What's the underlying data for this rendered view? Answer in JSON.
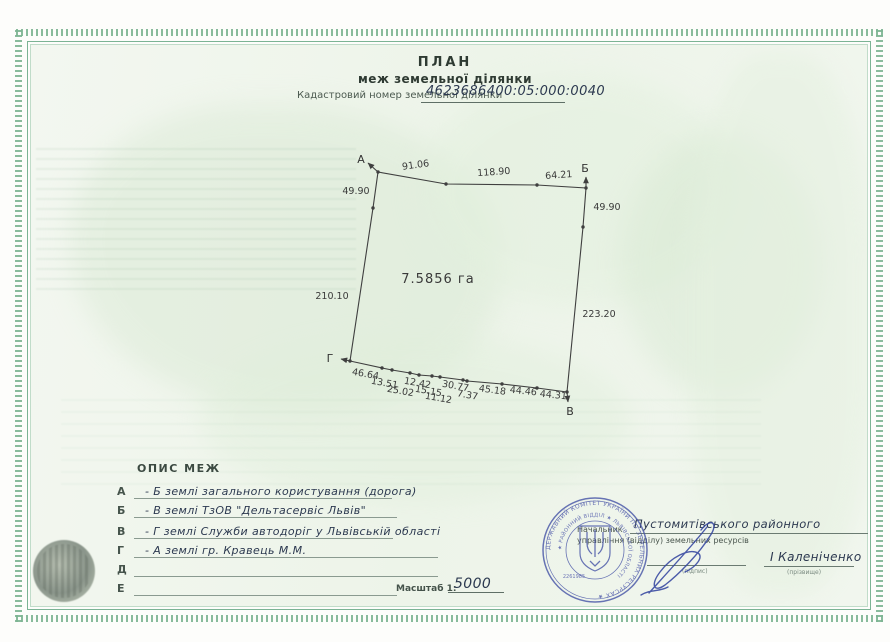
{
  "document": {
    "title": "ПЛАН",
    "subtitle": "меж земельної ділянки",
    "cadastral_label": "Кадастровий номер земельної ділянки",
    "cadastral_number": "4623686400:05:000:0040"
  },
  "plot": {
    "area_label": "7.5856 га",
    "vertices": {
      "a": "А",
      "b": "Б",
      "v": "В",
      "g": "Г"
    },
    "top_edges": [
      "91.06",
      "118.90",
      "64.21"
    ],
    "left_edges": [
      "49.90",
      "210.10"
    ],
    "right_edges": [
      "49.90",
      "223.20"
    ],
    "bottom_edges": [
      "46.64",
      "13.51",
      "25.02",
      "12.42",
      "15.15",
      "11.12",
      "30.77",
      "7.37",
      "45.18",
      "44.46",
      "44.31"
    ]
  },
  "boundaries": {
    "title": "ОПИС МЕЖ",
    "rows": [
      {
        "letter": "А",
        "text": "- Б землі загального користування (дорога)"
      },
      {
        "letter": "Б",
        "text": "- В землі ТзОВ \"Дельтасервіс Львів\""
      },
      {
        "letter": "В",
        "text": "- Г землі Служби автодоріг у Львівській області"
      },
      {
        "letter": "Г",
        "text": "- А землі гр. Кравець М.М."
      },
      {
        "letter": "Д",
        "text": ""
      },
      {
        "letter": "Е",
        "text": ""
      }
    ]
  },
  "scale": {
    "label": "Масштаб 1:",
    "value": "5000"
  },
  "signing": {
    "title_line1": "Начальник",
    "region_handwritten": "Пустомитівського районного",
    "title_line2": "управління (відділу) земельних ресурсів",
    "signature_caption": "(підпис)",
    "name": "І Каленіченко",
    "name_caption": "(прізвище)"
  },
  "stamp": {
    "outer_ring_text": "ДЕРЖАВНИЙ КОМІТЕТ УКРАЇНИ ПО ЗЕМЕЛЬНИХ РЕСУРСАХ ★",
    "inner_ring_text": "★ РАЙОННИЙ ВІДДІЛ ★ ЛЬВІВСЬКОЇ ОБЛАСТІ",
    "number": "2261985"
  },
  "colors": {
    "border_green": "#7cb492",
    "stamp_blue": "#4553a6",
    "drawing_ink": "#3f3f3f"
  }
}
